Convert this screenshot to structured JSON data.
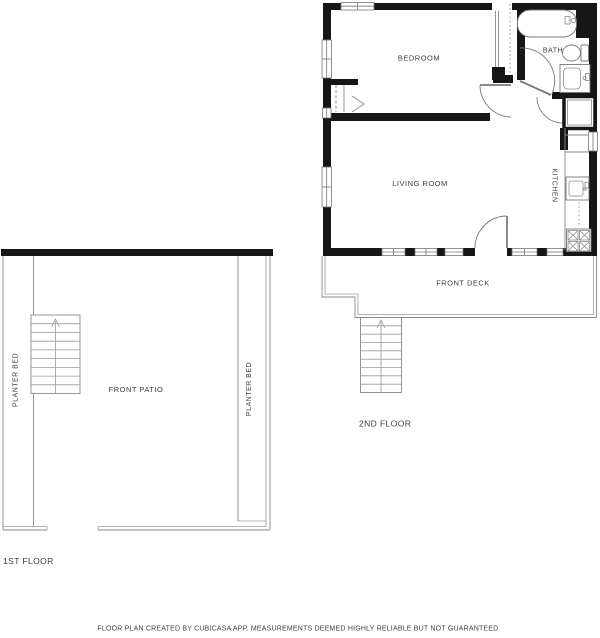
{
  "document": {
    "type": "floor-plan",
    "colors": {
      "wall": "#161616",
      "thin_line": "#8a8a8a",
      "door_line": "#7a7a7a",
      "text": "#3d3d3d",
      "background": "#ffffff"
    }
  },
  "second_floor": {
    "floor_label": "2ND FLOOR",
    "rooms": {
      "bedroom": {
        "label": "BEDROOM"
      },
      "bath": {
        "label": "BATH"
      },
      "living_room": {
        "label": "LIVING ROOM"
      },
      "kitchen": {
        "label": "KITCHEN"
      },
      "front_deck": {
        "label": "FRONT DECK"
      }
    },
    "fixtures": [
      "bathtub-icon",
      "toilet-icon",
      "bathroom-sink-icon",
      "shower-icon",
      "wardrobe-icon",
      "closet-bifold-icon",
      "kitchen-sink-icon",
      "dishwasher-icon",
      "stove-icon",
      "stairs-icon",
      "window-icon",
      "door-swing-icon"
    ]
  },
  "first_floor": {
    "floor_label": "1ST FLOOR",
    "rooms": {
      "front_patio": {
        "label": "FRONT PATIO"
      },
      "planter_bed_left": {
        "label": "PLANTER BED"
      },
      "planter_bed_right": {
        "label": "PLANTER BED"
      }
    },
    "fixtures": [
      "stairs-icon"
    ]
  },
  "footer": {
    "disclaimer": "FLOOR PLAN CREATED BY CUBICASA APP. MEASUREMENTS DEEMED HIGHLY RELIABLE BUT NOT GUARANTEED."
  }
}
